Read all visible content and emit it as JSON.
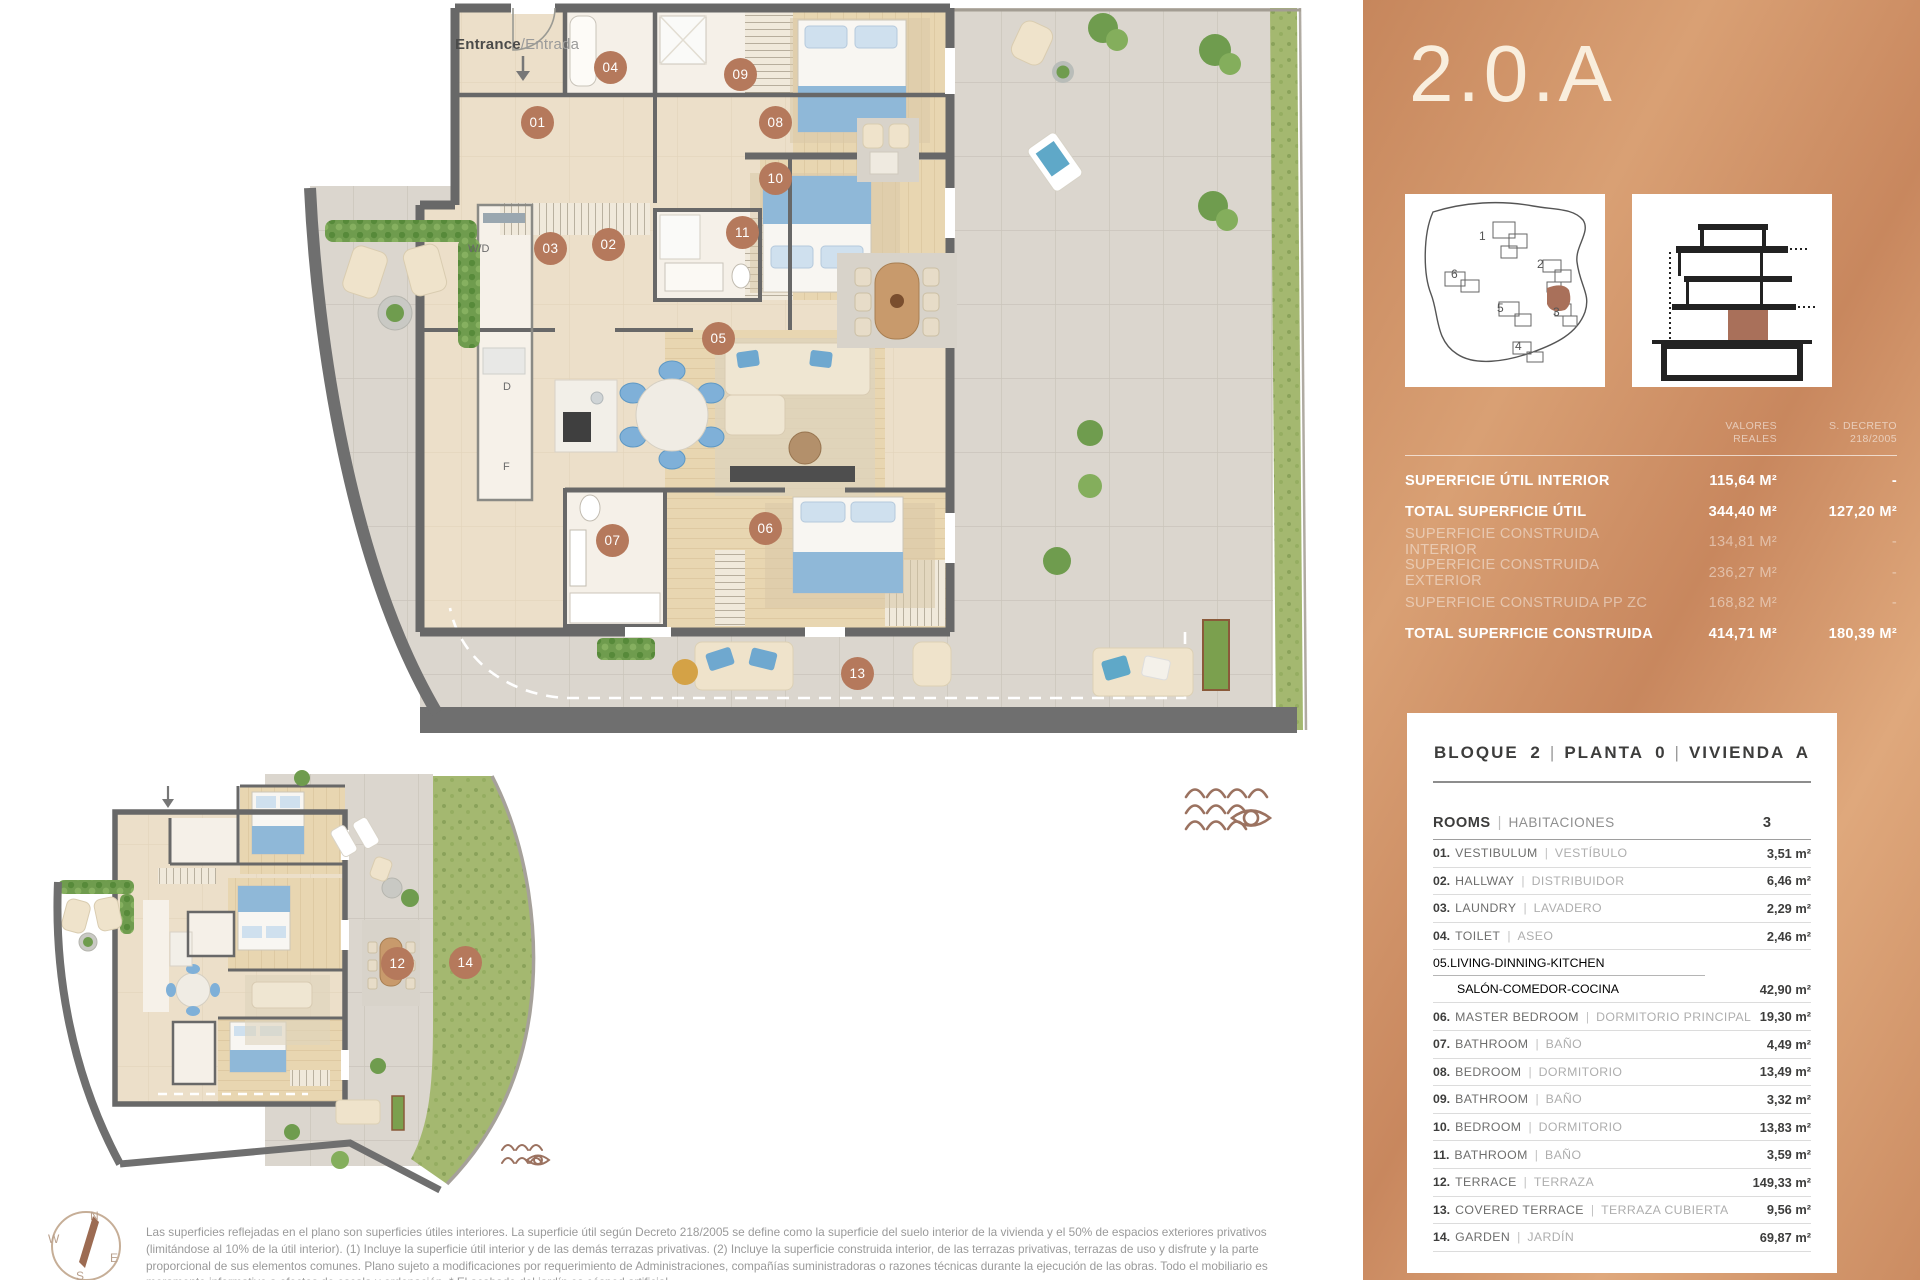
{
  "plan": {
    "entrance": {
      "en": "Entrance",
      "sep": "/",
      "es": "Entrada"
    },
    "labels": {
      "washer_dryer": "W/D",
      "dishwasher": "D",
      "fridge": "F"
    },
    "badge_color": "#b5795c",
    "badges_main": [
      {
        "n": "01",
        "x": 537,
        "y": 122
      },
      {
        "n": "02",
        "x": 608,
        "y": 244
      },
      {
        "n": "03",
        "x": 550,
        "y": 248
      },
      {
        "n": "04",
        "x": 610,
        "y": 67
      },
      {
        "n": "05",
        "x": 718,
        "y": 338
      },
      {
        "n": "06",
        "x": 765,
        "y": 528
      },
      {
        "n": "07",
        "x": 612,
        "y": 540
      },
      {
        "n": "08",
        "x": 775,
        "y": 122
      },
      {
        "n": "09",
        "x": 740,
        "y": 74
      },
      {
        "n": "10",
        "x": 775,
        "y": 178
      },
      {
        "n": "11",
        "x": 742,
        "y": 232
      },
      {
        "n": "13",
        "x": 857,
        "y": 673
      }
    ],
    "badges_small": [
      {
        "n": "12",
        "x": 397,
        "y": 963
      },
      {
        "n": "14",
        "x": 465,
        "y": 962
      }
    ]
  },
  "compass": {
    "n": "N",
    "e": "E",
    "s": "S",
    "w": "W"
  },
  "disclaimer": [
    "Las superficies reflejadas en el plano son superficies útiles interiores. La superficie útil según Decreto 218/2005 se define como la superficie del suelo interior de la vivienda y el 50% de espacios exteriores privativos",
    "(limitándose al 10% de la útil interior). (1) Incluye la superficie útil interior y de las demás terrazas privativas. (2) Incluye la superficie construida interior, de las terrazas privativas, terrazas de uso y disfrute y la parte",
    "proporcional de sus elementos comunes. Plano sujeto a modificaciones por requerimiento de Administraciones, compañías suministradoras o razones técnicas durante la ejecución de las obras. Todo el mobiliario es",
    "meramente informativo a efectos de escala y ordenación. * El acabado del jardín es césped artificial."
  ],
  "sidebar": {
    "title": "2.0.A",
    "surface_table": {
      "col1": [
        "VALORES",
        "REALES"
      ],
      "col2": [
        "S. DECRETO",
        "218/2005"
      ],
      "rows": [
        {
          "label": "SUPERFICIE ÚTIL INTERIOR",
          "real": "115,64 m²",
          "decreto": "-",
          "strong": true
        },
        {
          "label": "TOTAL SUPERFICIE ÚTIL",
          "real": "344,40 m²",
          "decreto": "127,20 m²",
          "strong": true
        },
        {
          "label": "SUPERFICIE CONSTRUIDA INTERIOR",
          "real": "134,81 m²",
          "decreto": "-",
          "strong": false
        },
        {
          "label": "SUPERFICIE CONSTRUIDA EXTERIOR",
          "real": "236,27 m²",
          "decreto": "-",
          "strong": false
        },
        {
          "label": "SUPERFICIE CONSTRUIDA PP ZC",
          "real": "168,82 m²",
          "decreto": "-",
          "strong": false
        },
        {
          "label": "TOTAL SUPERFICIE CONSTRUIDA",
          "real": "414,71 m²",
          "decreto": "180,39 m²",
          "strong": true
        }
      ]
    },
    "card": {
      "header": [
        "BLOQUE 2",
        "PLANTA 0",
        "VIVIENDA A"
      ],
      "header_sep": "|",
      "rooms_en": "ROOMS",
      "rooms_sep": "|",
      "rooms_es": "HABITACIONES",
      "rooms_count": "3",
      "rows": [
        {
          "num": "01.",
          "en": "VESTIBULUM",
          "es": "VESTÍBULO",
          "area": "3,51 m²"
        },
        {
          "num": "02.",
          "en": "HALLWAY",
          "es": "DISTRIBUIDOR",
          "area": "6,46 m²"
        },
        {
          "num": "03.",
          "en": "LAUNDRY",
          "es": "LAVADERO",
          "area": "2,29 m²"
        },
        {
          "num": "04.",
          "en": "TOILET",
          "es": "ASEO",
          "area": "2,46 m²"
        },
        {
          "num": "05.",
          "en": "LIVING-DINNING-KITCHEN",
          "es": "SALÓN-COMEDOR-COCINA",
          "area": "42,90 m²",
          "twoline": true
        },
        {
          "num": "06.",
          "en": "MASTER BEDROOM",
          "es": "DORMITORIO PRINCIPAL",
          "area": "19,30 m²"
        },
        {
          "num": "07.",
          "en": "BATHROOM",
          "es": "BAÑO",
          "area": "4,49 m²"
        },
        {
          "num": "08.",
          "en": "BEDROOM",
          "es": "DORMITORIO",
          "area": "13,49 m²"
        },
        {
          "num": "09.",
          "en": "BATHROOM",
          "es": "BAÑO",
          "area": "3,32 m²"
        },
        {
          "num": "10.",
          "en": "BEDROOM",
          "es": "DORMITORIO",
          "area": "13,83 m²"
        },
        {
          "num": "11.",
          "en": "BATHROOM",
          "es": "BAÑO",
          "area": "3,59 m²"
        },
        {
          "num": "12.",
          "en": "TERRACE",
          "es": "TERRAZA",
          "area": "149,33 m²"
        },
        {
          "num": "13.",
          "en": "COVERED TERRACE",
          "es": "TERRAZA CUBIERTA",
          "area": "9,56 m²"
        },
        {
          "num": "14.",
          "en": "GARDEN",
          "es": "JARDÍN",
          "area": "69,87 m²"
        }
      ]
    }
  }
}
